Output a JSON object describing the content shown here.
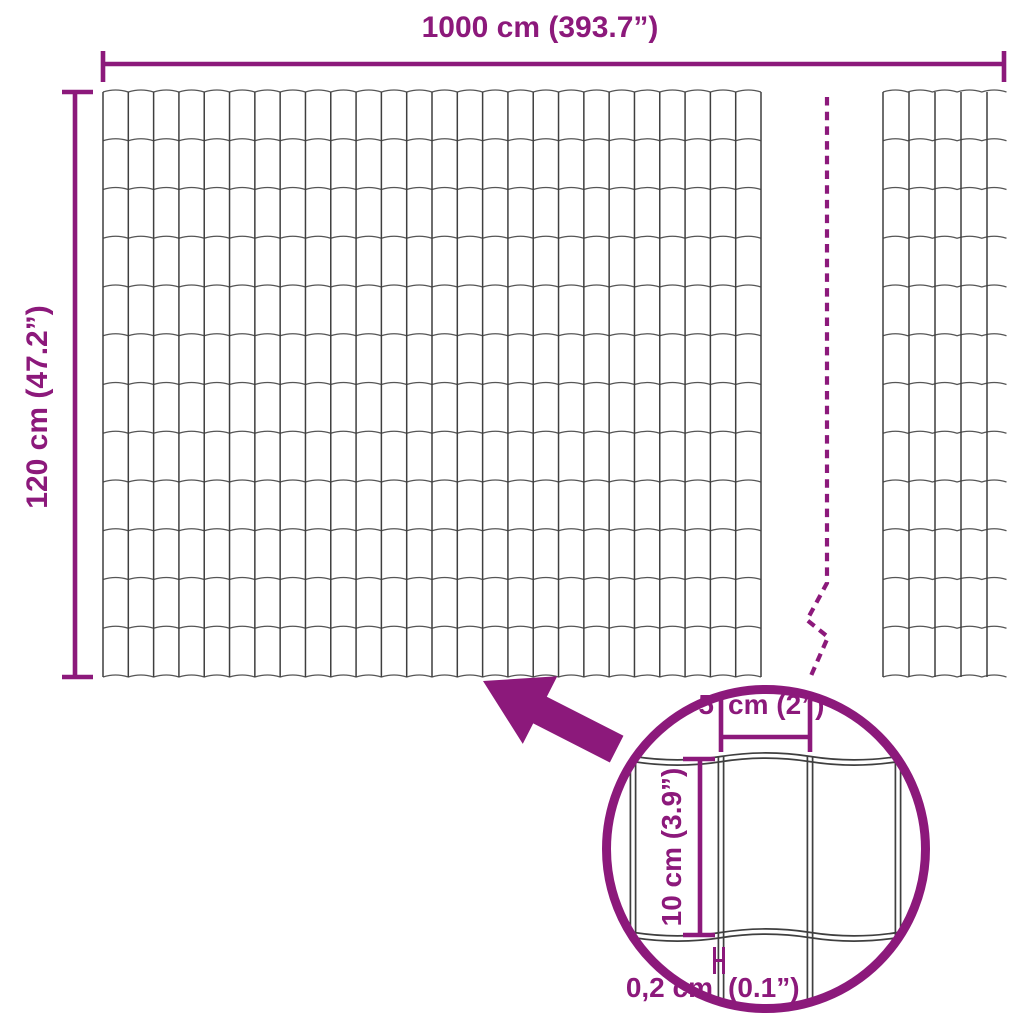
{
  "colors": {
    "accent": "#8C197B",
    "wire": "#3F3F3F"
  },
  "labels": {
    "total_width": "1000 cm (393.7”)",
    "total_height": "120 cm (47.2”)"
  },
  "magnifier": {
    "cell_width_num": "5",
    "cell_width_unit": "cm (2”)",
    "cell_height": "10 cm (3.9”)",
    "wire_thickness_num": "0,2 cm",
    "wire_thickness_unit": "(0.1”)"
  }
}
